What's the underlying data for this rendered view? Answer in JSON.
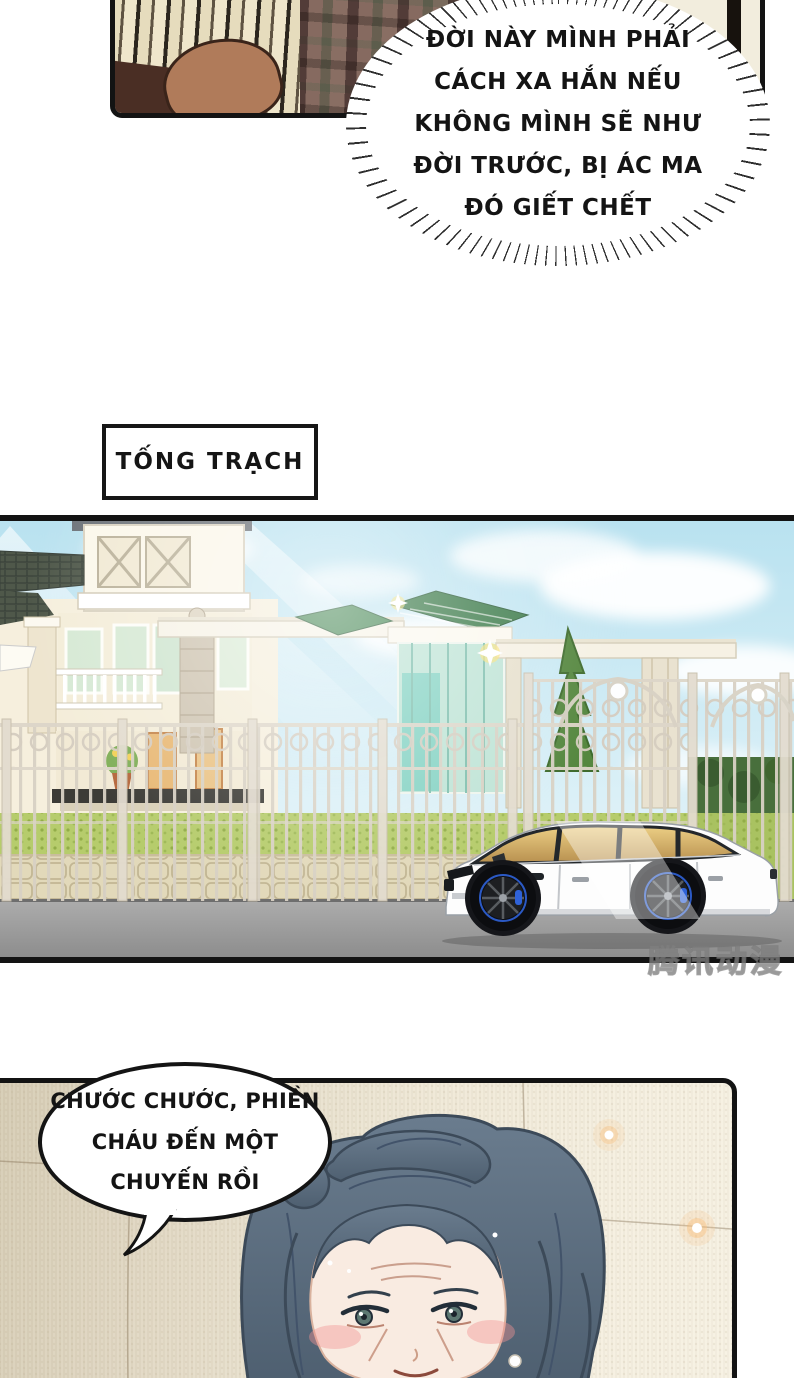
{
  "speech": {
    "burst": "ĐỜI NÀY MÌNH PHẢI\nCÁCH XA HẮN NẾU\nKHÔNG MÌNH SẼ NHƯ\nĐỜI TRƯỚC, BỊ ÁC MA\nĐÓ GIẾT CHẾT",
    "grandma": "CHƯỚC CHƯỚC, PHIỀN\nCHÁU ĐẾN MỘT\nCHUYẾN RỒI"
  },
  "location_label": "TỐNG TRẠCH",
  "watermark": "腾讯动漫",
  "colors": {
    "panel_border": "#131313",
    "sky": "#bfe4f1",
    "hedge": "#b6cc6c",
    "road": "#9d9d9d",
    "car_body": "#fdfdfd",
    "wheel_accent": "#2f62d8",
    "hair": "#5c6d7f",
    "room_wall": "#efe8d6"
  }
}
